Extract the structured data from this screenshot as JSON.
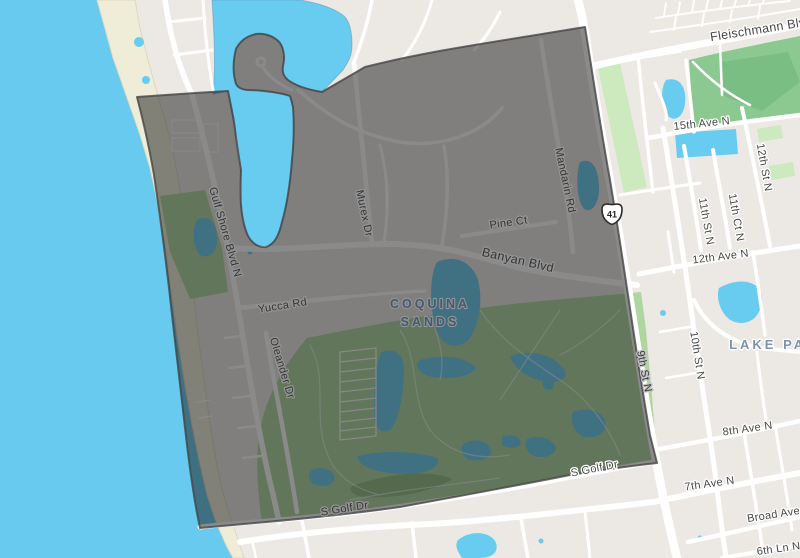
{
  "map": {
    "type": "neighborhood-boundary-map",
    "neighborhood": {
      "name_line1": "COQUINA",
      "name_line2": "SANDS"
    },
    "adjacent_area": {
      "name": "LAKE PARK"
    },
    "route_shield": {
      "type": "us-route-shield",
      "number": "41"
    },
    "streets": [
      {
        "name": "Gulf Shore Blvd N"
      },
      {
        "name": "Murex Dr"
      },
      {
        "name": "Mandarin Rd"
      },
      {
        "name": "Pine Ct"
      },
      {
        "name": "Banyan Blvd"
      },
      {
        "name": "Yucca Rd"
      },
      {
        "name": "Oleander Dr"
      },
      {
        "name": "S Golf Dr"
      },
      {
        "name": "S Golf Dr"
      },
      {
        "name": "9th St N"
      },
      {
        "name": "10th St N"
      },
      {
        "name": "11th St N"
      },
      {
        "name": "11th Ct N"
      },
      {
        "name": "12th St N"
      },
      {
        "name": "12th Ave N"
      },
      {
        "name": "15th Ave N"
      },
      {
        "name": "Fleischmann Blvd"
      },
      {
        "name": "8th Ave N"
      },
      {
        "name": "7th Ave N"
      },
      {
        "name": "Broad Ave"
      },
      {
        "name": "6th Ln N"
      }
    ],
    "colors": {
      "water": "#68caef",
      "beach": "#efecd8",
      "land": "#ece9e4",
      "road": "#ffffff",
      "park": "#8cc990",
      "park_light": "#cde9be",
      "golf": "#afd6a0",
      "pond": "#68ccf0",
      "overlay_fill": "#151515",
      "overlay_border": "#454545",
      "street_label": "#474747",
      "neighborhood_label": "#4a586c",
      "area_label": "#7e92ae"
    }
  }
}
